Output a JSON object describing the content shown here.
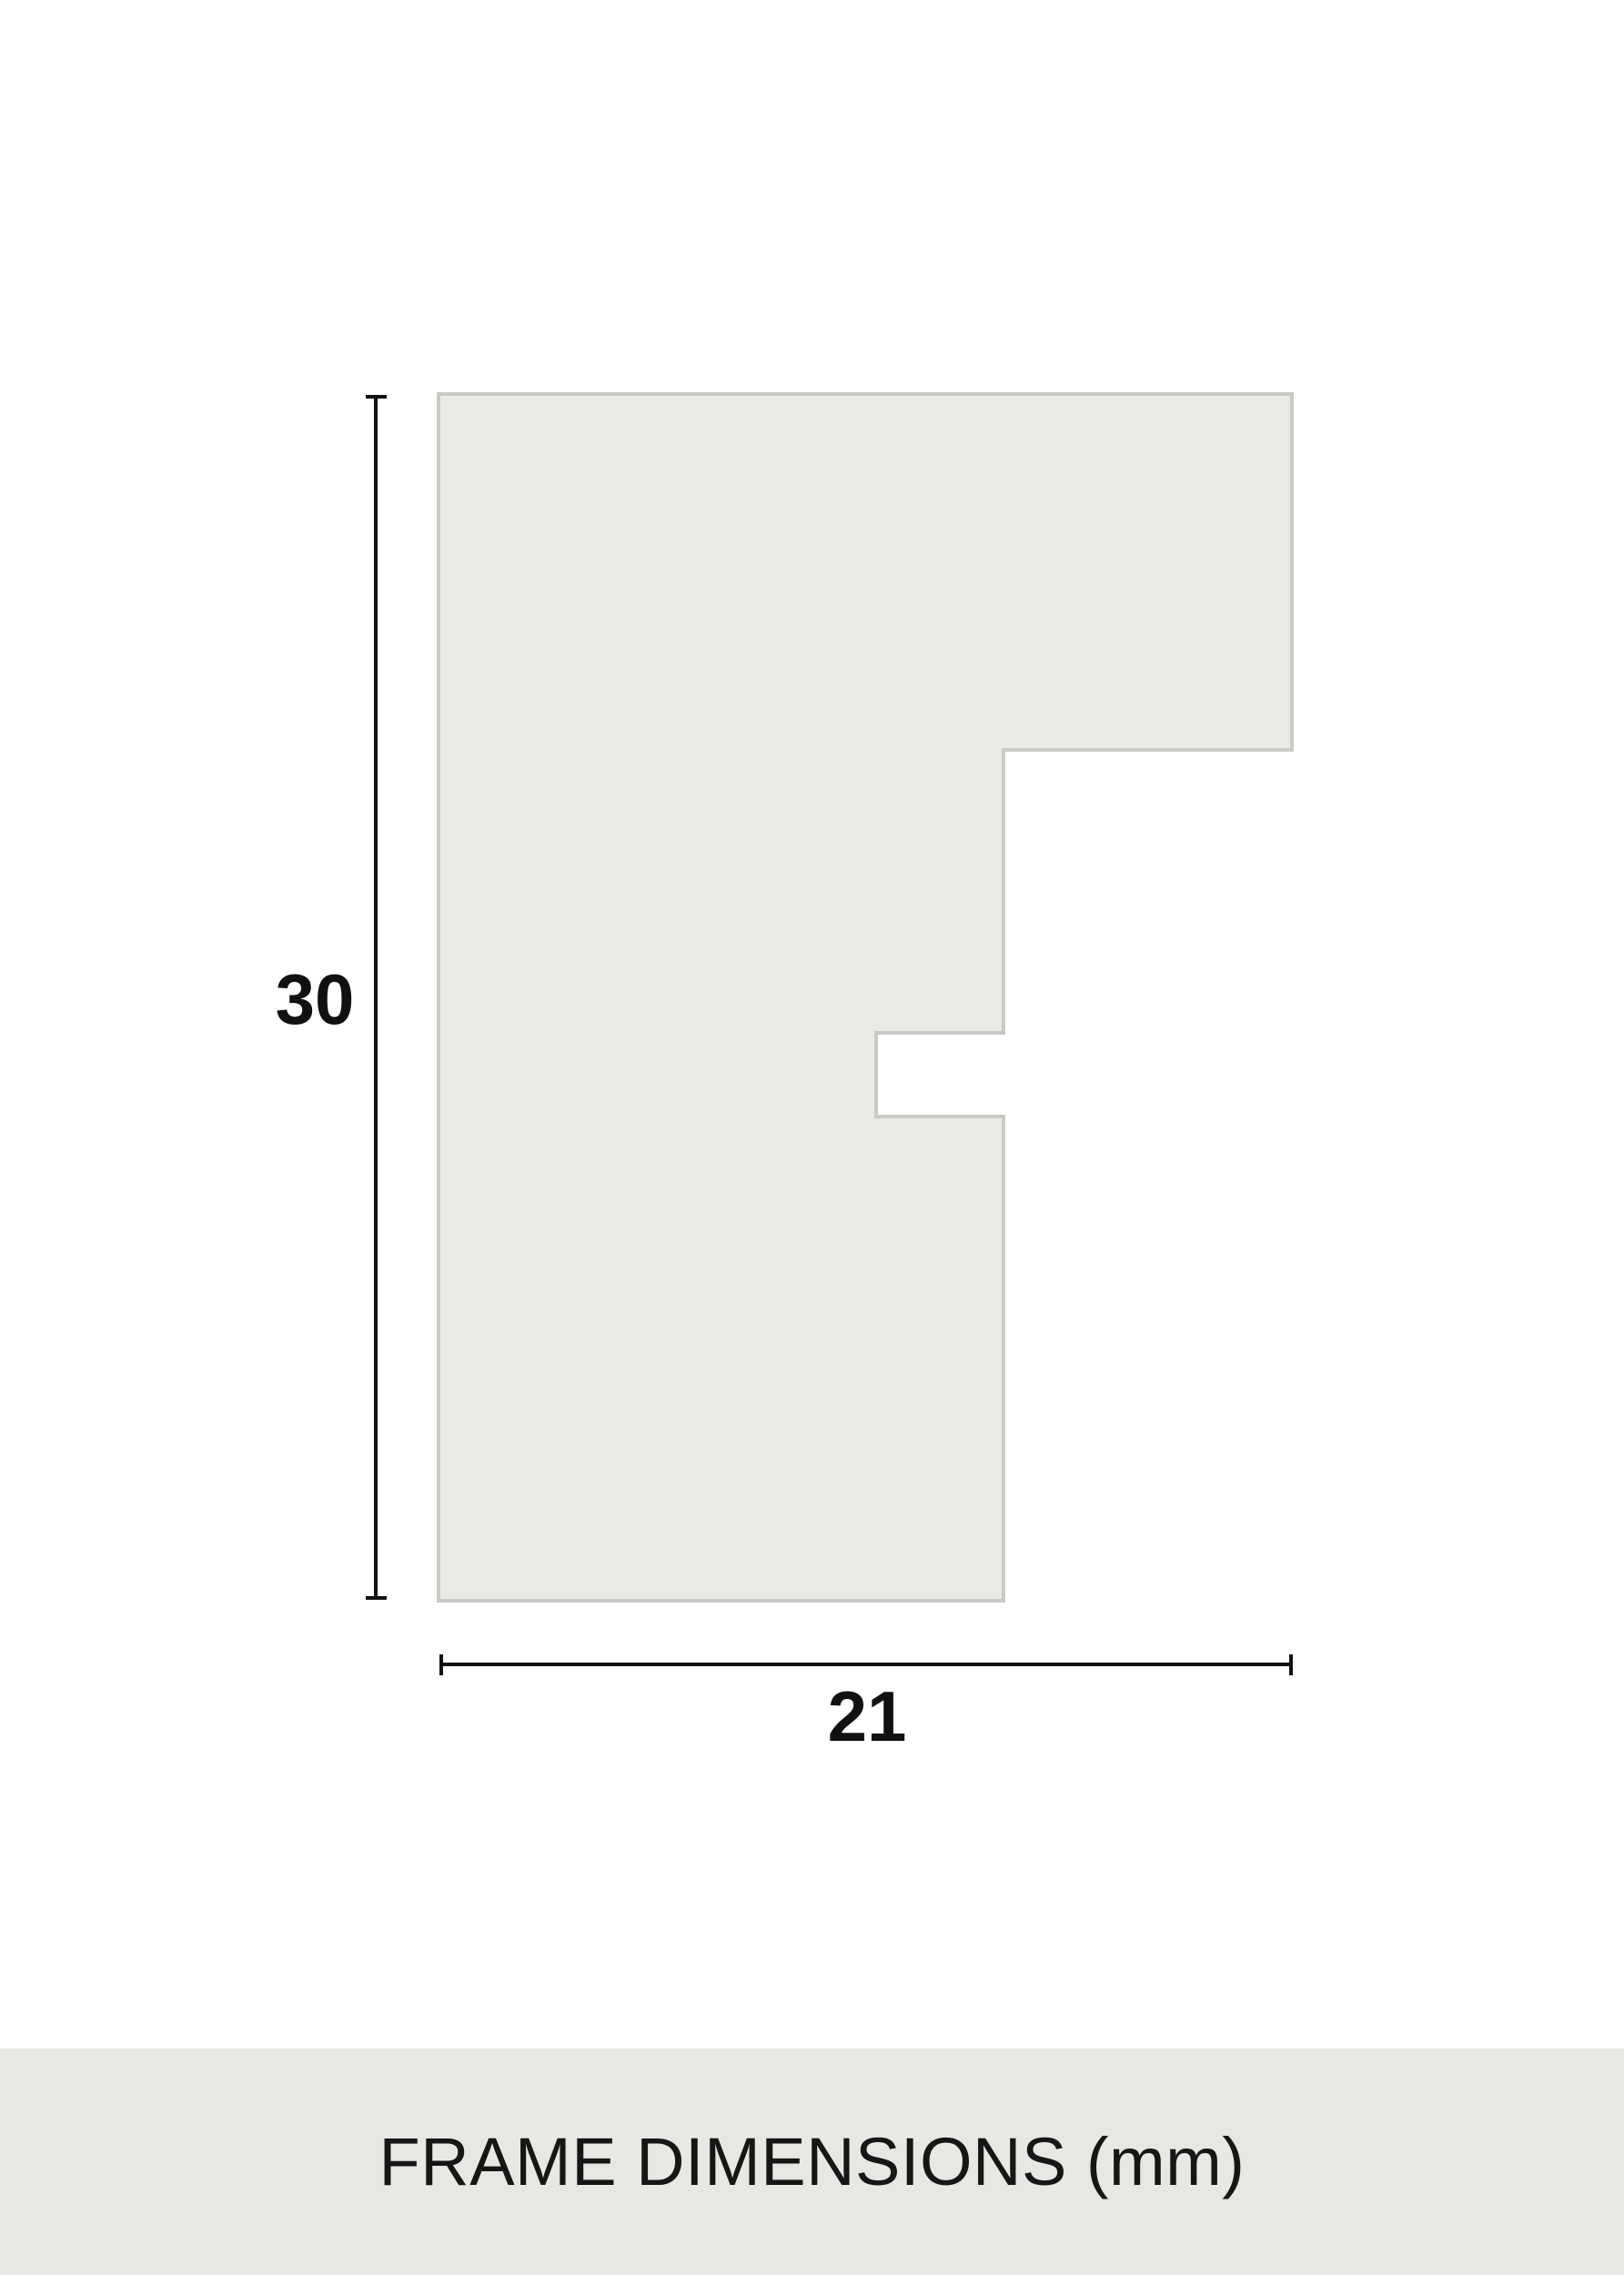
{
  "diagram": {
    "height_label": "30",
    "width_label": "21",
    "caption": "FRAME DIMENSIONS (mm)",
    "unit": "mm",
    "dimensions": {
      "height_mm": 30,
      "width_mm": 21
    },
    "colors": {
      "background": "#ffffff",
      "profile_fill": "#e9eae5",
      "profile_border": "#c9cac6",
      "caption_bar_bg": "#e7e8e3",
      "dimension_ink": "#111111"
    }
  }
}
